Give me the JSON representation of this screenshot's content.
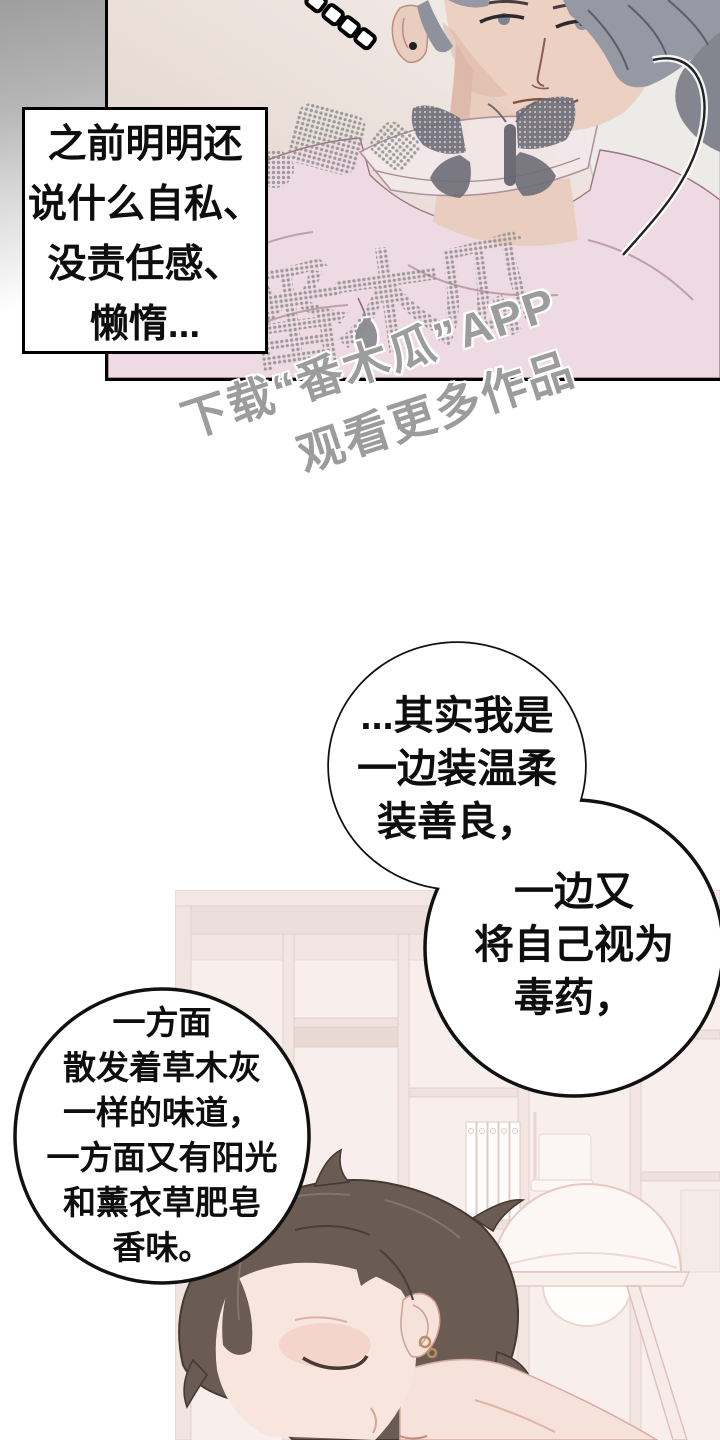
{
  "speech_box": {
    "lines": [
      "之前明明还",
      "说什么自私、",
      "没责任感、",
      "懒惰..."
    ]
  },
  "bubble_a": {
    "lines": [
      "...其实我是",
      "一边装温柔",
      "装善良，"
    ]
  },
  "bubble_b": {
    "lines": [
      "一边又",
      "将自己视为",
      "毒药，"
    ]
  },
  "bubble_c": {
    "lines": [
      "一方面",
      "散发着草木灰",
      "一样的味道，",
      "一方面又有阳光",
      "和薰衣草肥皂",
      "香味。"
    ]
  },
  "watermark": {
    "line1": "下载“番木瓜”APP",
    "line2": "观看更多作品",
    "logo_text": "番木瓜"
  },
  "colors": {
    "panel_bg": "#e8dbd4",
    "shirt_pink": "#eedae2",
    "hair_grey": "#9597a2",
    "hair_brown": "#6a5c52",
    "shelf_pink": "#f5e8e3",
    "watermark_grey": "#9c9c9c",
    "outline_black": "#111111"
  }
}
